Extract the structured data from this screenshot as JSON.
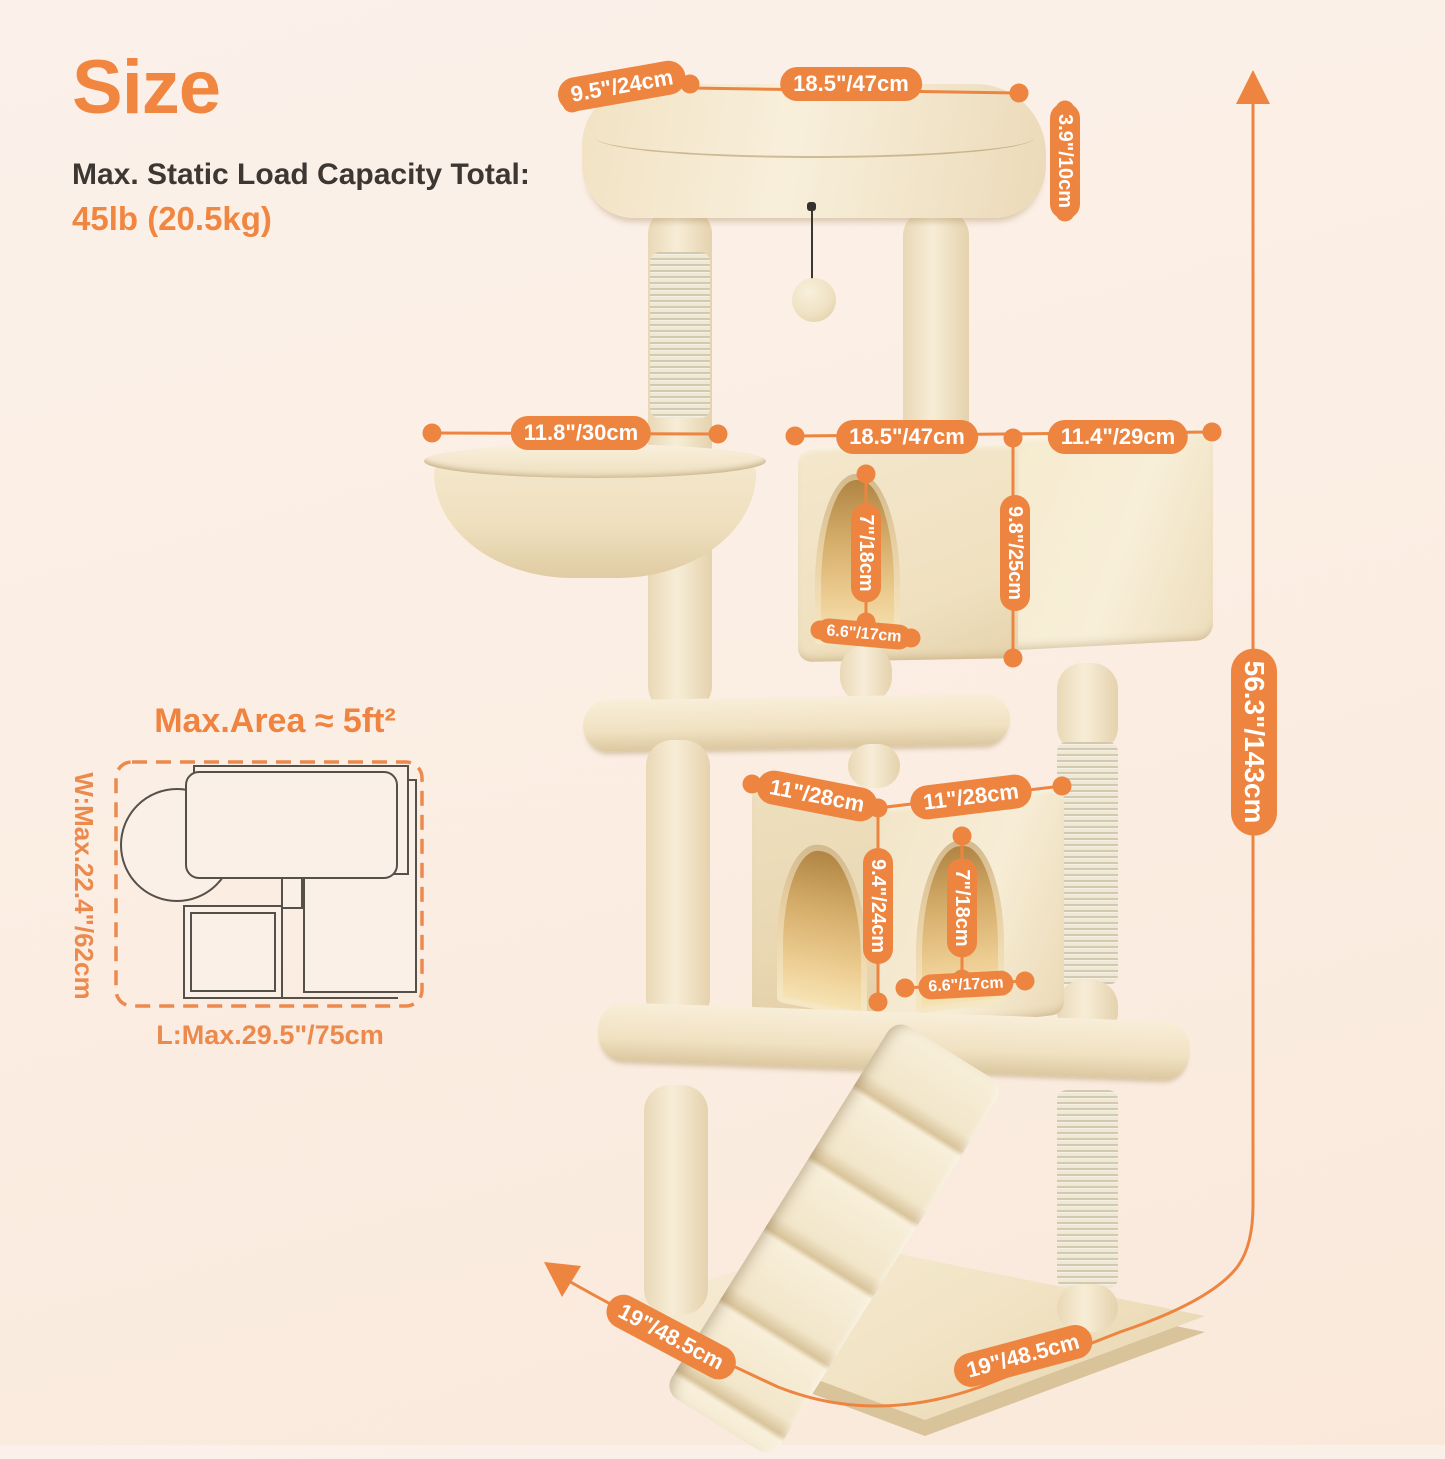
{
  "header": {
    "title": "Size",
    "subtitle": "Max. Static Load Capacity Total:",
    "capacity": "45lb (20.5kg)"
  },
  "measurements": {
    "top_depth": "9.5\"/24cm",
    "top_width": "18.5\"/47cm",
    "top_thickness": "3.9\"/10cm",
    "basket_diameter": "11.8\"/30cm",
    "mid_condo_width": "18.5\"/47cm",
    "mid_condo_depth": "11.4\"/29cm",
    "mid_door_height": "7\"/18cm",
    "mid_condo_height": "9.8\"/25cm",
    "mid_door_width": "6.6\"/17cm",
    "low_condo_width": "11\"/28cm",
    "low_condo_depth": "11\"/28cm",
    "low_condo_height": "9.4\"/24cm",
    "low_door_height": "7\"/18cm",
    "low_door_width": "6.6\"/17cm",
    "total_height": "56.3\"/143cm",
    "base_depth": "19\"/48.5cm",
    "base_width": "19\"/48.5cm"
  },
  "footprint": {
    "title": "Max.Area ≈ 5ft²",
    "width_label": "W:Max.22.4\"/62cm",
    "length_label": "L:Max.29.5\"/75cm"
  },
  "colors": {
    "accent": "#ED8540",
    "heading_orange": "#F0863F",
    "text_dark": "#3C3733",
    "plush_beige": "#F1E4C8"
  }
}
